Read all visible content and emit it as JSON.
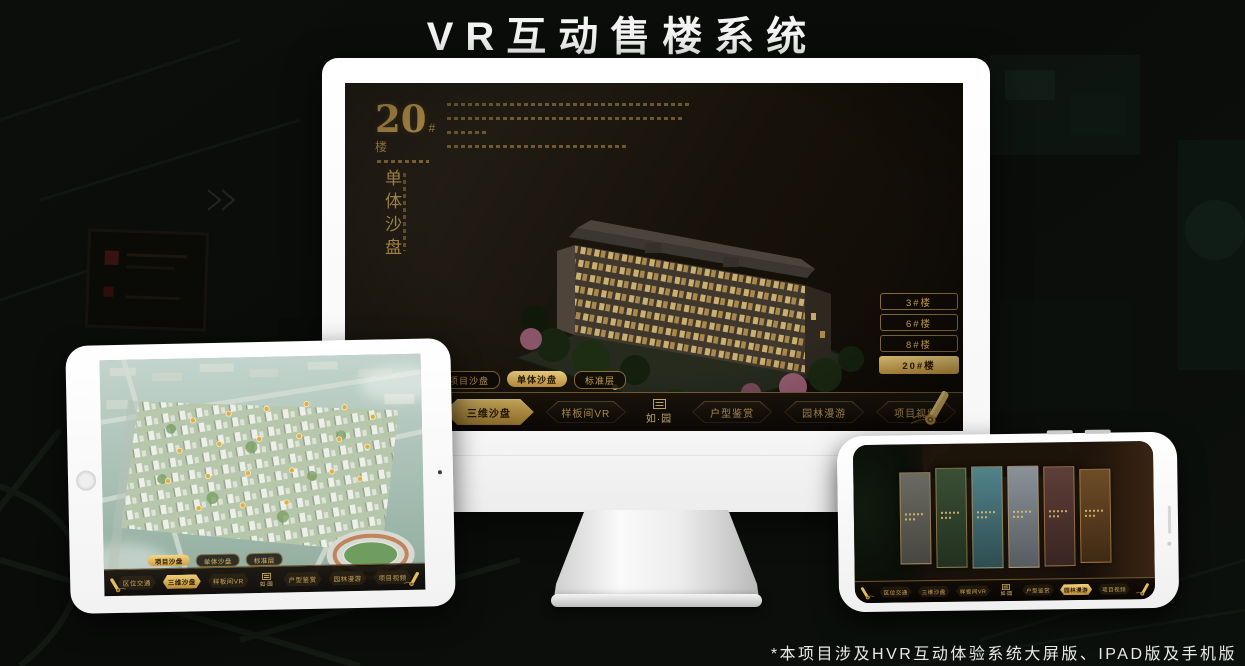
{
  "page": {
    "title": "VR互动售楼系统",
    "footnote": "*本项目涉及HVR互动体验系统大屏版、IPAD版及手机版"
  },
  "brand": {
    "logo_text": "如·园",
    "accent_gold": "#c8a35c",
    "selected_gold": "#e9c469",
    "screen_dark": "#15100a"
  },
  "icons": [
    "scroll-icon",
    "home-button",
    "camera-icon",
    "speaker-grille",
    "logo-emblem-icon"
  ],
  "monitor_ui": {
    "headline": {
      "number": "20",
      "suffix": "#楼",
      "subtitle": "单体沙盘"
    },
    "floor_buttons": [
      {
        "label": "3#楼",
        "active": false
      },
      {
        "label": "6#楼",
        "active": false
      },
      {
        "label": "8#楼",
        "active": false
      },
      {
        "label": "20#楼",
        "active": true
      }
    ],
    "tabs": [
      {
        "label": "项目沙盘",
        "active": false
      },
      {
        "label": "单体沙盘",
        "active": true
      },
      {
        "label": "标准层",
        "active": false
      }
    ],
    "nav_items": [
      {
        "label": "区位交通",
        "active": false
      },
      {
        "label": "三维沙盘",
        "active": true
      },
      {
        "label": "样板间VR",
        "active": false
      },
      {
        "label": "户型鉴赏",
        "active": false
      },
      {
        "label": "园林漫游",
        "active": false
      },
      {
        "label": "项目视频",
        "active": false
      }
    ]
  },
  "tablet_ui": {
    "tabs": [
      {
        "label": "项目沙盘",
        "active": true
      },
      {
        "label": "单体沙盘",
        "active": false
      },
      {
        "label": "标准层",
        "active": false
      }
    ],
    "nav_items": [
      {
        "label": "区位交通",
        "active": false
      },
      {
        "label": "三维沙盘",
        "active": true
      },
      {
        "label": "样板间VR",
        "active": false
      },
      {
        "label": "户型鉴赏",
        "active": false
      },
      {
        "label": "园林漫游",
        "active": false
      },
      {
        "label": "项目视频",
        "active": false
      }
    ]
  },
  "phone_ui": {
    "nav_items": [
      {
        "label": "区位交通",
        "active": false
      },
      {
        "label": "三维沙盘",
        "active": false
      },
      {
        "label": "样板间VR",
        "active": false
      },
      {
        "label": "户型鉴赏",
        "active": false
      },
      {
        "label": "园林漫游",
        "active": true
      },
      {
        "label": "项目视频",
        "active": false
      }
    ]
  }
}
